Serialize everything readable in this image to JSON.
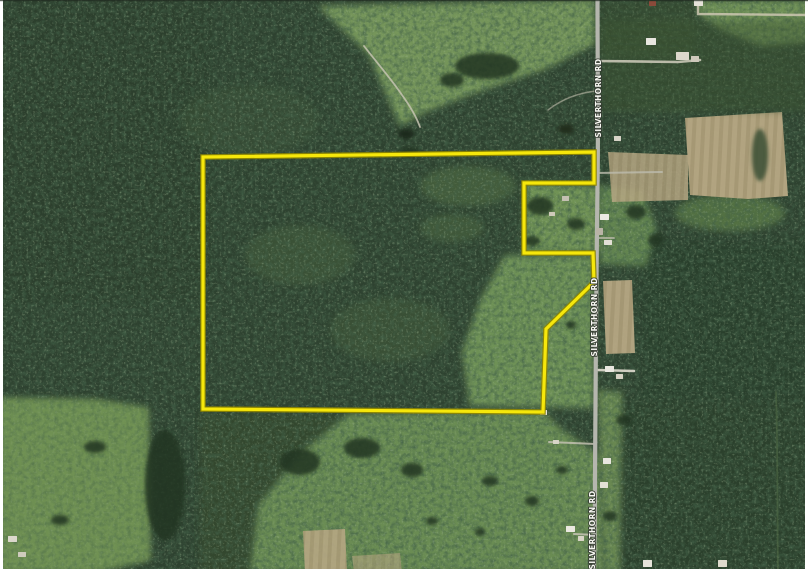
{
  "image": {
    "kind": "satellite-aerial-parcel-map",
    "width": 808,
    "height": 572
  },
  "palette": {
    "forest_base": "#2e4230",
    "field_green": "#74955a",
    "field_green_dark": "#6b8c52",
    "field_tan": "#b6a783",
    "road_gray": "#b5b6ae",
    "boundary_yellow": "#f6e70b",
    "boundary_underlay": "#8f8600",
    "frame_white": "#ffffff",
    "edge_line": "#1f2a20",
    "pond_dark": "#1e2c1c",
    "tree_dark": "#223420"
  },
  "road": {
    "name_label": "SILVERTHORN RD",
    "path": "M597.5,0 C597.5,70 598.5,130 597.5,185 C596.8,245 596.5,275 596,330 C595.5,385 595,430 595,475 C595,515 594.5,545 594,572",
    "width": 4.2,
    "labels": [
      {
        "text": "SILVERTHORN RD",
        "x": 601,
        "y": 98,
        "rot": -90
      },
      {
        "text": "SILVERTHORN RD",
        "x": 597,
        "y": 317,
        "rot": -90
      },
      {
        "text": "SILVERTHORN RD",
        "x": 595,
        "y": 530,
        "rot": -90
      }
    ]
  },
  "boundary": {
    "points": "203,157 594,152 594,183 524,183 524,253 593,253 594,282 546,329 543,412 203,409",
    "width": 3.2,
    "underlay_width": 5.6
  },
  "driveways": [
    {
      "d": "M598,61 L678,62 L700,60",
      "w": 2.6,
      "c": "#c9c6b6",
      "o": 0.9
    },
    {
      "d": "M698,0 L698,14 L808,15",
      "w": 2.4,
      "c": "#cdc7b2",
      "o": 0.85
    },
    {
      "d": "M596,173 L662,172",
      "w": 2.0,
      "c": "#bdbcae",
      "o": 0.8
    },
    {
      "d": "M598,238 L614,238",
      "w": 1.8,
      "c": "#c4c1b2",
      "o": 0.8
    },
    {
      "d": "M597,370 L634,371",
      "w": 2.6,
      "c": "#d8d5c8",
      "o": 0.95
    },
    {
      "d": "M596,444 L549,442",
      "w": 2.0,
      "c": "#c2bfb0",
      "o": 0.85
    },
    {
      "d": "M596,535 L574,534",
      "w": 2.0,
      "c": "#c6c3b4",
      "o": 0.85
    },
    {
      "d": "M364,46 C378,64 392,80 402,95 C410,106 416,116 420,127",
      "w": 1.8,
      "c": "#c6c3b2",
      "o": 0.85
    },
    {
      "d": "M548,110 C562,99 578,93 596,91",
      "w": 1.6,
      "c": "#bfbcab",
      "o": 0.6
    },
    {
      "d": "M776,392 C778,450 777,510 778,572",
      "w": 1.8,
      "c": "#4d6743",
      "o": 0.65
    }
  ],
  "terrain": {
    "patches": [
      {
        "kind": "polygon",
        "layer": 1,
        "points": "0,0 210,0 210,300 0,300",
        "fill": "#2a3e2c",
        "o": 0.45,
        "blur": true
      },
      {
        "kind": "polygon",
        "layer": 1,
        "points": "640,240 808,240 808,400 640,400",
        "fill": "#283c2b",
        "o": 0.5,
        "blur": true
      },
      {
        "kind": "polygon",
        "layer": 1,
        "points": "620,400 808,400 808,572 620,572",
        "fill": "#2b3f2c",
        "o": 0.5,
        "blur": true
      },
      {
        "kind": "polygon",
        "layer": 1,
        "points": "318,6 595,0 595,44 548,68 472,94 426,112 400,126 368,54",
        "fill": "#74955a",
        "o": 1,
        "blur": true
      },
      {
        "kind": "polygon",
        "layer": 1,
        "points": "695,0 808,0 808,42 762,46 722,30 700,16",
        "fill": "#6f9157",
        "o": 1,
        "blur": true
      },
      {
        "kind": "polygon",
        "layer": 1,
        "points": "524,183 600,186 600,253 524,253",
        "fill": "#6f9254",
        "o": 1,
        "blur": true
      },
      {
        "kind": "polygon",
        "layer": 1,
        "points": "600,186 642,190 656,228 646,266 600,264",
        "fill": "#688c52",
        "o": 0.9,
        "blur": true
      },
      {
        "kind": "polygon",
        "layer": 1,
        "points": "505,255 594,256 594,408 470,406 462,352 480,300",
        "fill": "#6e9156",
        "o": 1,
        "blur": true
      },
      {
        "kind": "polygon",
        "layer": 1,
        "points": "200,412 345,414 305,450 258,504 250,572 200,572",
        "fill": "#35492f",
        "o": 0.85,
        "blur": true
      },
      {
        "kind": "polygon",
        "layer": 1,
        "points": "348,414 543,411 560,428 600,455 603,572 250,572 258,505 302,452",
        "fill": "#6b8c52",
        "o": 1,
        "blur": true
      },
      {
        "kind": "polygon",
        "layer": 1,
        "points": "598,390 622,392 620,572 603,572",
        "fill": "#6f9055",
        "o": 0.9,
        "blur": true
      },
      {
        "kind": "polygon",
        "layer": 1,
        "points": "0,398 96,400 148,408 150,560 95,572 0,572",
        "fill": "#719253",
        "o": 1,
        "blur": true
      },
      {
        "kind": "ellipse",
        "layer": 1,
        "cx": 730,
        "cy": 213,
        "rx": 55,
        "ry": 18,
        "fill": "#5f8049",
        "o": 0.75,
        "blur": true
      },
      {
        "kind": "ellipse",
        "layer": 1,
        "cx": 468,
        "cy": 186,
        "rx": 48,
        "ry": 20,
        "fill": "#547244",
        "o": 0.55,
        "blur": true
      },
      {
        "kind": "ellipse",
        "layer": 1,
        "cx": 452,
        "cy": 228,
        "rx": 32,
        "ry": 14,
        "fill": "#547244",
        "o": 0.45,
        "blur": true
      },
      {
        "kind": "ellipse",
        "layer": 1,
        "cx": 300,
        "cy": 255,
        "rx": 55,
        "ry": 30,
        "fill": "#46603c",
        "o": 0.5,
        "blur": true
      },
      {
        "kind": "ellipse",
        "layer": 1,
        "cx": 390,
        "cy": 330,
        "rx": 60,
        "ry": 32,
        "fill": "#46603c",
        "o": 0.45,
        "blur": true
      },
      {
        "kind": "ellipse",
        "layer": 1,
        "cx": 250,
        "cy": 120,
        "rx": 70,
        "ry": 35,
        "fill": "#40583a",
        "o": 0.4,
        "blur": true
      },
      {
        "kind": "polygon",
        "layer": 2,
        "points": "685,118 782,112 788,196 748,199 690,195",
        "fill": "@crop",
        "o": 0.96,
        "blur": false
      },
      {
        "kind": "polygon",
        "layer": 2,
        "points": "608,152 688,155 688,200 612,202",
        "fill": "@crop",
        "o": 0.85,
        "blur": false
      },
      {
        "kind": "polygon",
        "layer": 2,
        "points": "603,281 632,280 635,353 606,354",
        "fill": "@crop",
        "o": 0.95,
        "blur": false
      },
      {
        "kind": "polygon",
        "layer": 2,
        "points": "303,531 345,529 347,572 305,572",
        "fill": "@crop",
        "o": 0.9,
        "blur": false
      },
      {
        "kind": "polygon",
        "layer": 2,
        "points": "352,556 400,553 402,572 354,572",
        "fill": "@crop",
        "o": 0.6,
        "blur": false
      },
      {
        "kind": "rect",
        "layer": 2,
        "x": 600,
        "y": 20,
        "w": 208,
        "h": 92,
        "fill": "@rows",
        "o": 0.45,
        "blur": true
      },
      {
        "kind": "rect",
        "layer": 2,
        "x": 600,
        "y": 0,
        "w": 95,
        "h": 55,
        "fill": "@rows",
        "o": 0.35,
        "blur": true
      },
      {
        "kind": "polygon",
        "layer": 2,
        "points": "0,398 96,400 148,408 150,560 95,572 0,572",
        "fill": "@frows",
        "o": 0.4,
        "blur": true
      }
    ],
    "ponds": [
      {
        "cx": 406,
        "cy": 134,
        "rx": 8,
        "ry": 5,
        "fill": "#1e2c1c",
        "o": 1
      },
      {
        "cx": 566,
        "cy": 129,
        "rx": 8,
        "ry": 5,
        "fill": "#202e1e",
        "o": 1
      },
      {
        "cx": 760,
        "cy": 155,
        "rx": 8,
        "ry": 26,
        "fill": "#3a5034",
        "o": 0.85
      }
    ],
    "clusters": [
      {
        "cx": 487,
        "cy": 66,
        "rx": 32,
        "ry": 13
      },
      {
        "cx": 452,
        "cy": 80,
        "rx": 12,
        "ry": 7
      },
      {
        "cx": 540,
        "cy": 206,
        "rx": 13,
        "ry": 9
      },
      {
        "cx": 532,
        "cy": 241,
        "rx": 8,
        "ry": 5
      },
      {
        "cx": 576,
        "cy": 224,
        "rx": 9,
        "ry": 6
      },
      {
        "cx": 571,
        "cy": 325,
        "rx": 5,
        "ry": 4
      },
      {
        "cx": 362,
        "cy": 448,
        "rx": 18,
        "ry": 10
      },
      {
        "cx": 412,
        "cy": 470,
        "rx": 11,
        "ry": 7
      },
      {
        "cx": 300,
        "cy": 462,
        "rx": 20,
        "ry": 13
      },
      {
        "cx": 490,
        "cy": 481,
        "rx": 8,
        "ry": 5
      },
      {
        "cx": 532,
        "cy": 501,
        "rx": 7,
        "ry": 5
      },
      {
        "cx": 562,
        "cy": 470,
        "rx": 6,
        "ry": 4
      },
      {
        "cx": 432,
        "cy": 521,
        "rx": 6,
        "ry": 4
      },
      {
        "cx": 480,
        "cy": 532,
        "rx": 5,
        "ry": 4
      },
      {
        "cx": 165,
        "cy": 485,
        "rx": 20,
        "ry": 55
      },
      {
        "cx": 95,
        "cy": 447,
        "rx": 11,
        "ry": 6
      },
      {
        "cx": 60,
        "cy": 520,
        "rx": 9,
        "ry": 5
      },
      {
        "cx": 636,
        "cy": 212,
        "rx": 10,
        "ry": 7
      },
      {
        "cx": 656,
        "cy": 240,
        "rx": 8,
        "ry": 6
      },
      {
        "cx": 624,
        "cy": 420,
        "rx": 8,
        "ry": 5
      },
      {
        "cx": 610,
        "cy": 516,
        "rx": 7,
        "ry": 5
      },
      {
        "cx": 410,
        "cy": 152,
        "rx": 10,
        "ry": 5
      }
    ]
  },
  "buildings": [
    {
      "x": 646,
      "y": 38,
      "w": 10,
      "h": 7,
      "fill": "#e8e6df"
    },
    {
      "x": 676,
      "y": 52,
      "w": 13,
      "h": 8,
      "fill": "#ddd8cc"
    },
    {
      "x": 691,
      "y": 56,
      "w": 8,
      "h": 6,
      "fill": "#cfc9bb"
    },
    {
      "x": 694,
      "y": 0,
      "w": 9,
      "h": 6,
      "fill": "#e5e2d8"
    },
    {
      "x": 649,
      "y": 1,
      "w": 7,
      "h": 5,
      "fill": "#8a4a3a"
    },
    {
      "x": 614,
      "y": 136,
      "w": 7,
      "h": 5,
      "fill": "#d8d4c8"
    },
    {
      "x": 600,
      "y": 214,
      "w": 9,
      "h": 6,
      "fill": "#eceae2"
    },
    {
      "x": 596,
      "y": 228,
      "w": 7,
      "h": 7,
      "fill": "#b9b4a6"
    },
    {
      "x": 604,
      "y": 240,
      "w": 8,
      "h": 5,
      "fill": "#e3e0d6"
    },
    {
      "x": 562,
      "y": 196,
      "w": 7,
      "h": 5,
      "fill": "#c4c0b2"
    },
    {
      "x": 549,
      "y": 212,
      "w": 6,
      "h": 4,
      "fill": "#cfcaba"
    },
    {
      "x": 605,
      "y": 366,
      "w": 9,
      "h": 6,
      "fill": "#eae8e0"
    },
    {
      "x": 616,
      "y": 374,
      "w": 7,
      "h": 5,
      "fill": "#d6d2c4"
    },
    {
      "x": 603,
      "y": 458,
      "w": 8,
      "h": 6,
      "fill": "#e9e7df"
    },
    {
      "x": 600,
      "y": 482,
      "w": 8,
      "h": 6,
      "fill": "#e4e1d7"
    },
    {
      "x": 566,
      "y": 526,
      "w": 9,
      "h": 6,
      "fill": "#eae8e0"
    },
    {
      "x": 578,
      "y": 536,
      "w": 6,
      "h": 5,
      "fill": "#d8d4c6"
    },
    {
      "x": 8,
      "y": 536,
      "w": 9,
      "h": 6,
      "fill": "#dcd8cc"
    },
    {
      "x": 18,
      "y": 552,
      "w": 8,
      "h": 5,
      "fill": "#cfcbbd"
    },
    {
      "x": 643,
      "y": 560,
      "w": 9,
      "h": 7,
      "fill": "#e6e3da"
    },
    {
      "x": 718,
      "y": 560,
      "w": 9,
      "h": 7,
      "fill": "#dedacd"
    },
    {
      "x": 553,
      "y": 440,
      "w": 6,
      "h": 4,
      "fill": "#d9d5c8"
    },
    {
      "x": 540,
      "y": 410,
      "w": 7,
      "h": 5,
      "fill": "#e6e4da"
    }
  ]
}
